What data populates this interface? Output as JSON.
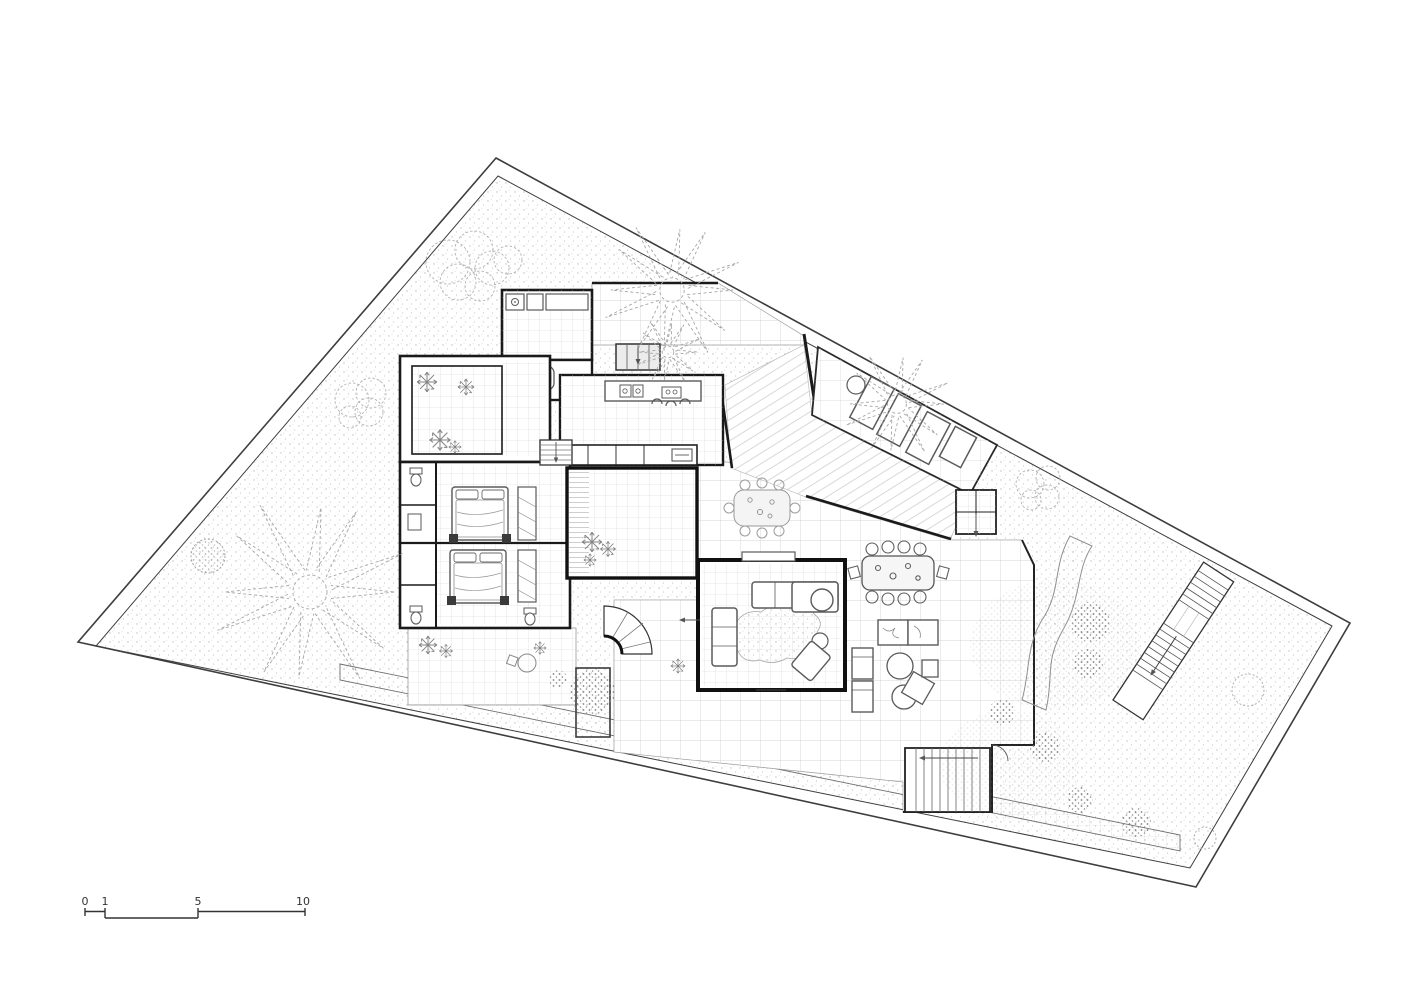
{
  "drawing": {
    "kind": "architectural-site-floor-plan",
    "colors": {
      "paper": "#ffffff",
      "ink": "#1a1a1a",
      "wall": "#111111",
      "tile_grid": "#cdcdcd",
      "stipple": "#bcbcbc",
      "vegetation": "#8a8a8a",
      "furniture": "#5a5a5a"
    }
  },
  "scale_bar": {
    "labels": [
      "0",
      "1",
      "5",
      "10"
    ]
  }
}
